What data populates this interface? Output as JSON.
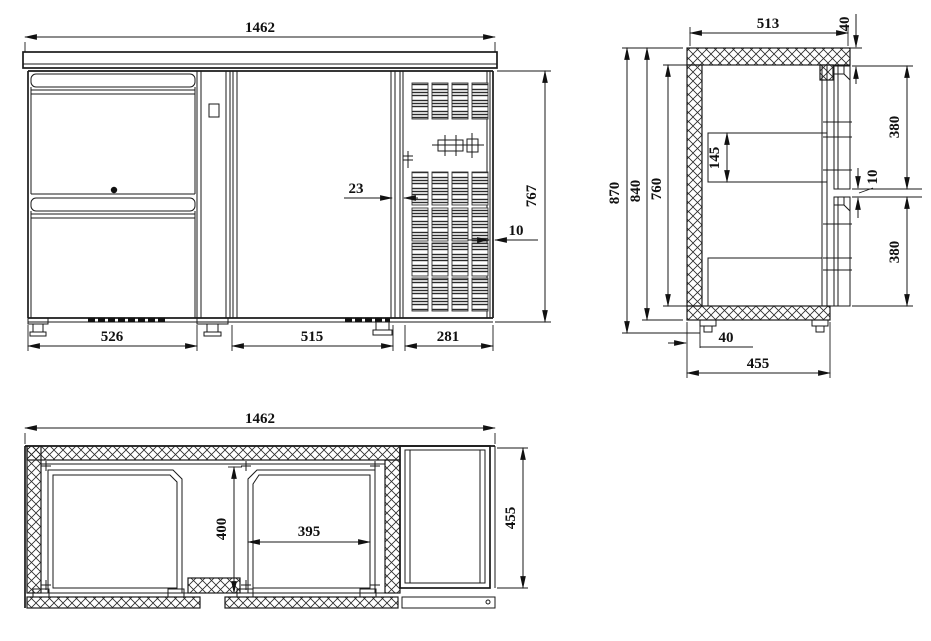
{
  "views": {
    "front": {
      "overall_width": "1462",
      "drawer_section_width": "526",
      "door_width": "515",
      "vent_section_width": "281",
      "body_height": "767",
      "door_edge_gap": "23",
      "panel_edge_gap": "10"
    },
    "side": {
      "overall_depth": "513",
      "door_top_offset": "40",
      "overall_height": "870",
      "case_height": "840",
      "interior_height": "760",
      "evaporator_height": "145",
      "upper_door_height": "380",
      "door_gap": "10",
      "lower_door_height": "380",
      "wall_thickness": "40",
      "case_depth": "455"
    },
    "plan": {
      "overall_width": "1462",
      "case_depth": "455",
      "door_opening_depth": "400",
      "door_opening_width": "395"
    }
  },
  "colors": {
    "line": "#1a1a1a",
    "background": "#ffffff"
  }
}
